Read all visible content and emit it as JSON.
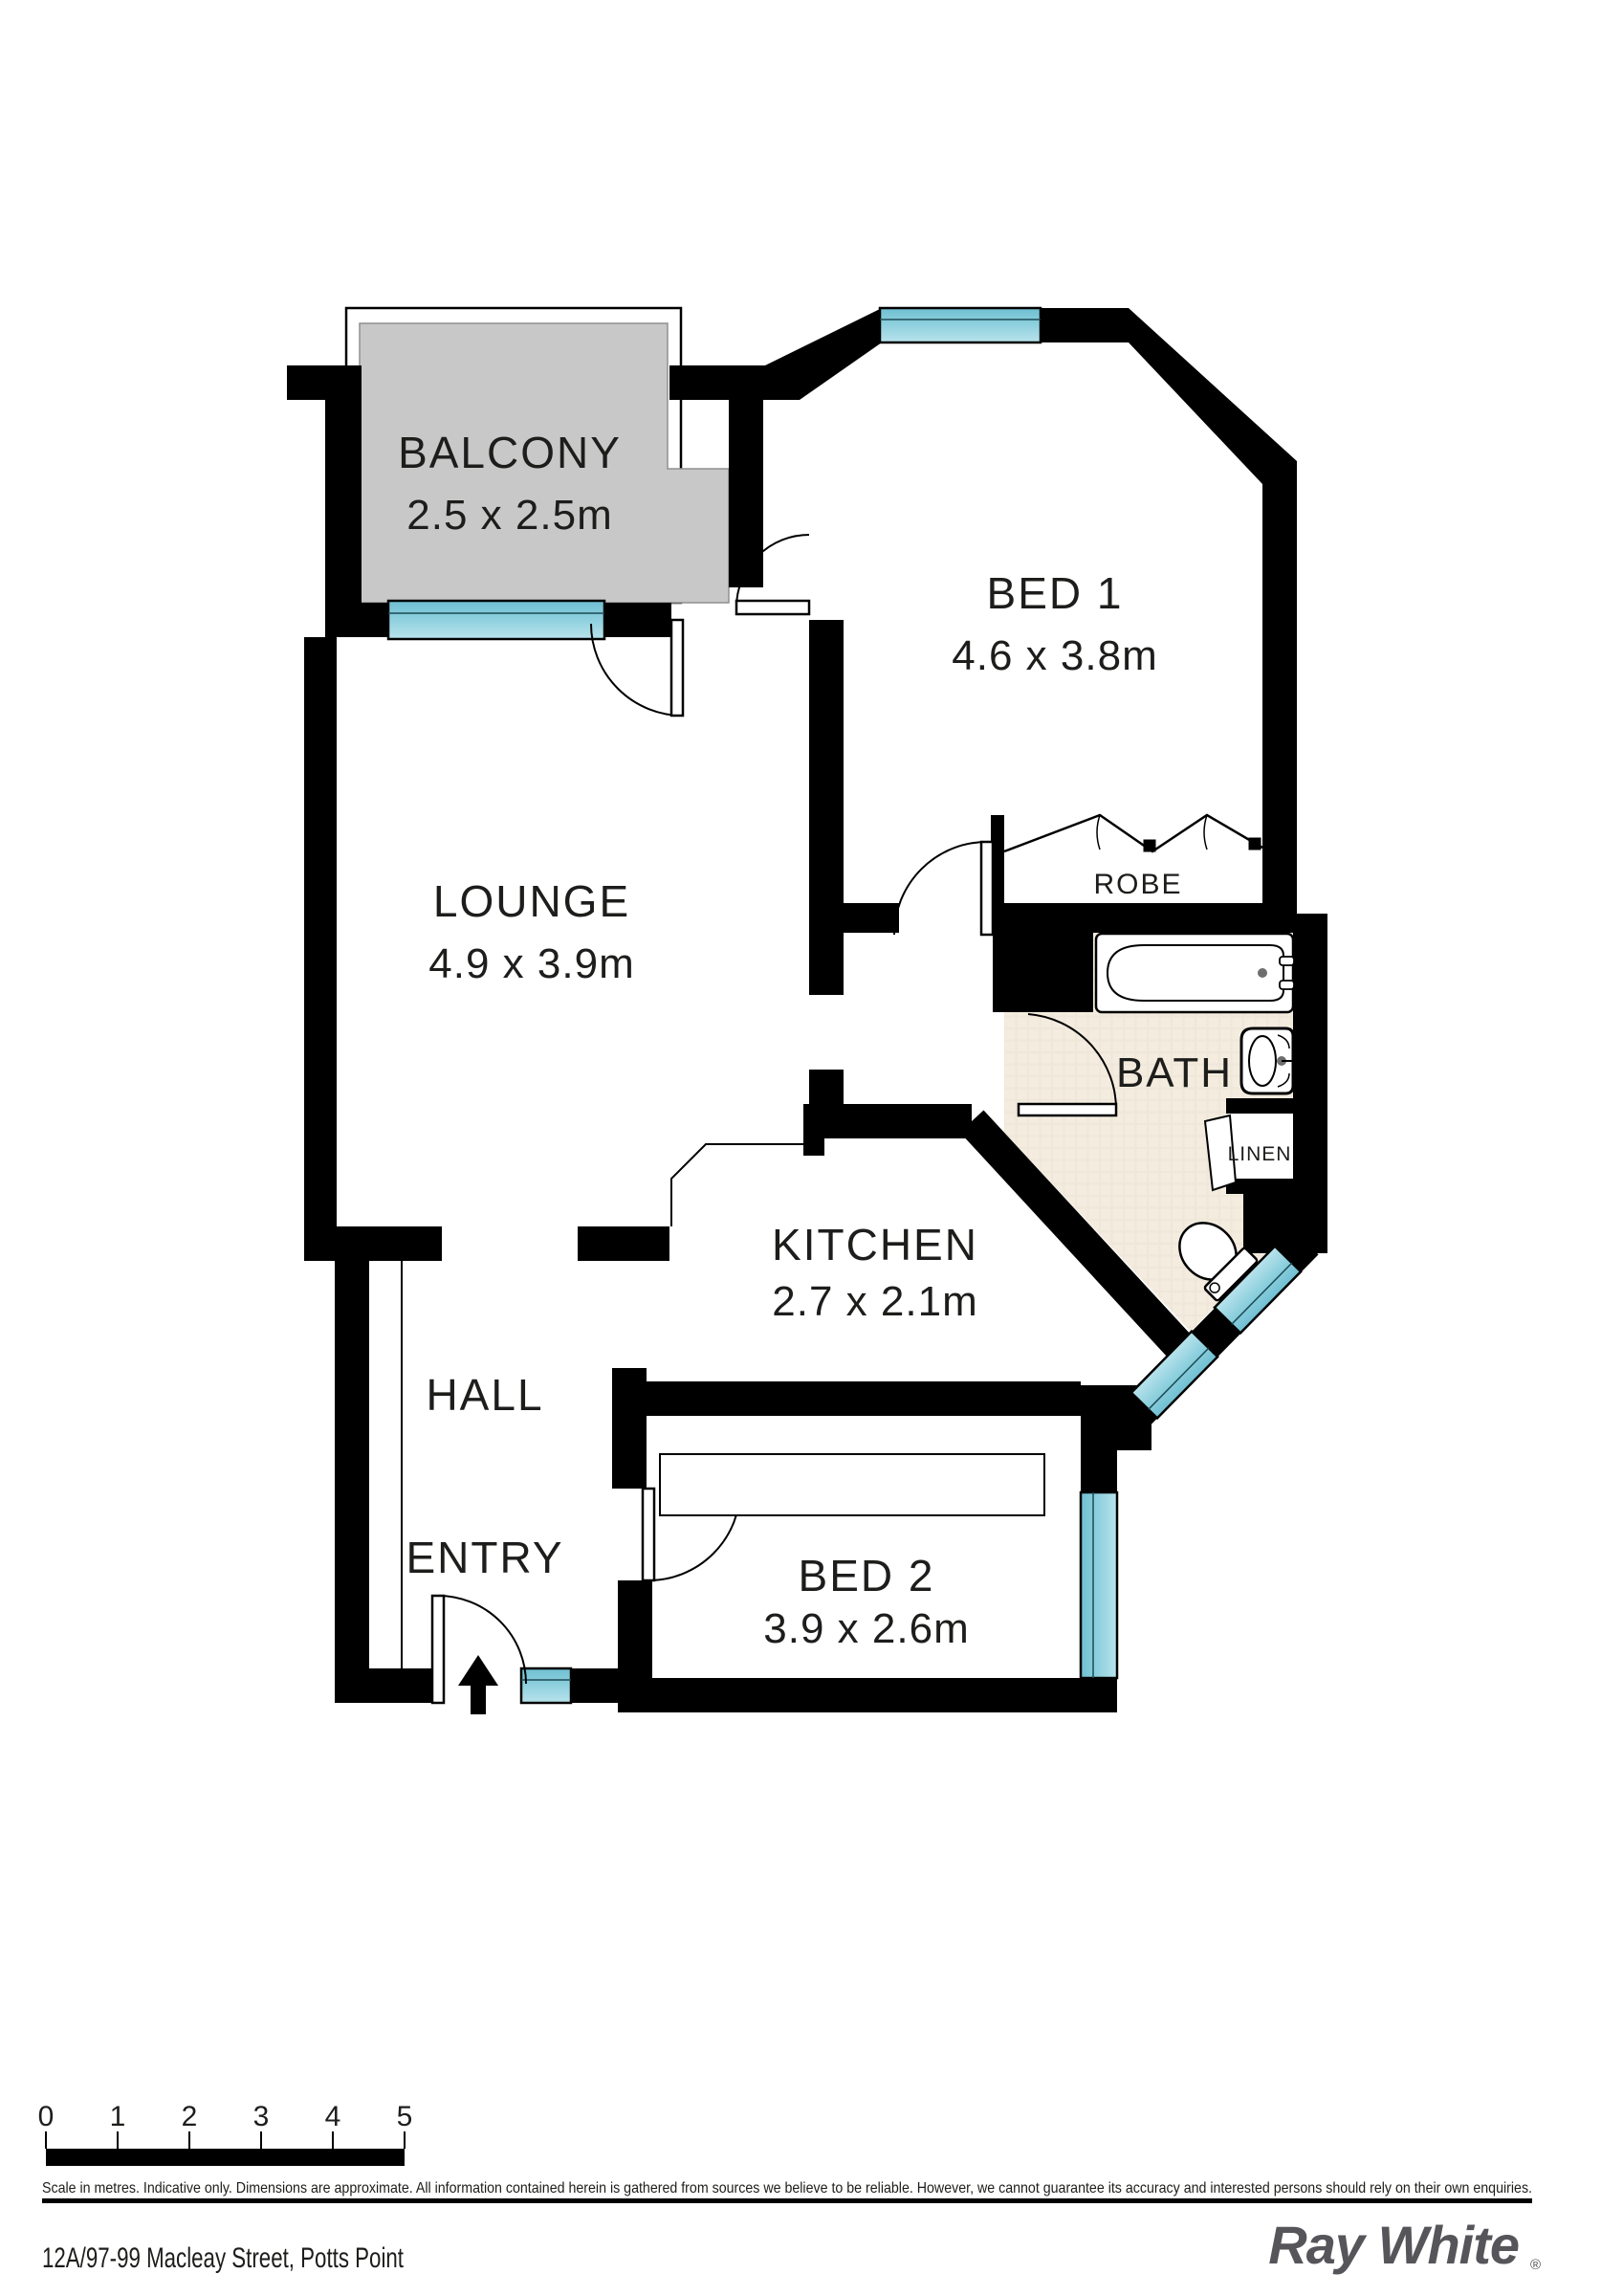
{
  "title": "Floor plan",
  "rooms": {
    "balcony": {
      "name": "BALCONY",
      "dims": "2.5 x 2.5m"
    },
    "bed1": {
      "name": "BED 1",
      "dims": "4.6 x 3.8m"
    },
    "lounge": {
      "name": "LOUNGE",
      "dims": "4.9 x 3.9m"
    },
    "kitchen": {
      "name": "KITCHEN",
      "dims": "2.7 x 2.1m"
    },
    "bed2": {
      "name": "BED 2",
      "dims": "3.9 x 2.6m"
    },
    "hall": {
      "name": "HALL"
    },
    "entry": {
      "name": "ENTRY"
    },
    "robe": {
      "name": "ROBE"
    },
    "bath": {
      "name": "BATH"
    },
    "linen": {
      "name": "LINEN"
    }
  },
  "scale_bar": {
    "ticks": [
      "0",
      "1",
      "2",
      "3",
      "4",
      "5"
    ],
    "caption": "Scale in metres. Indicative only. Dimensions are approximate. All information contained herein is gathered from sources we believe to be reliable. However, we cannot guarantee its accuracy and interested persons should rely on their own enquiries."
  },
  "footer": {
    "address": "12A/97-99 Macleay Street, Potts Point",
    "brand": "Ray White",
    "registered_mark": "®"
  },
  "colors": {
    "wall": "#000000",
    "window": "#79c5d6",
    "window_light": "#b3dfe8",
    "balcony_slab": "#c8c8c8",
    "bath_tile": "#efe7d9",
    "logo": "#55555a"
  }
}
